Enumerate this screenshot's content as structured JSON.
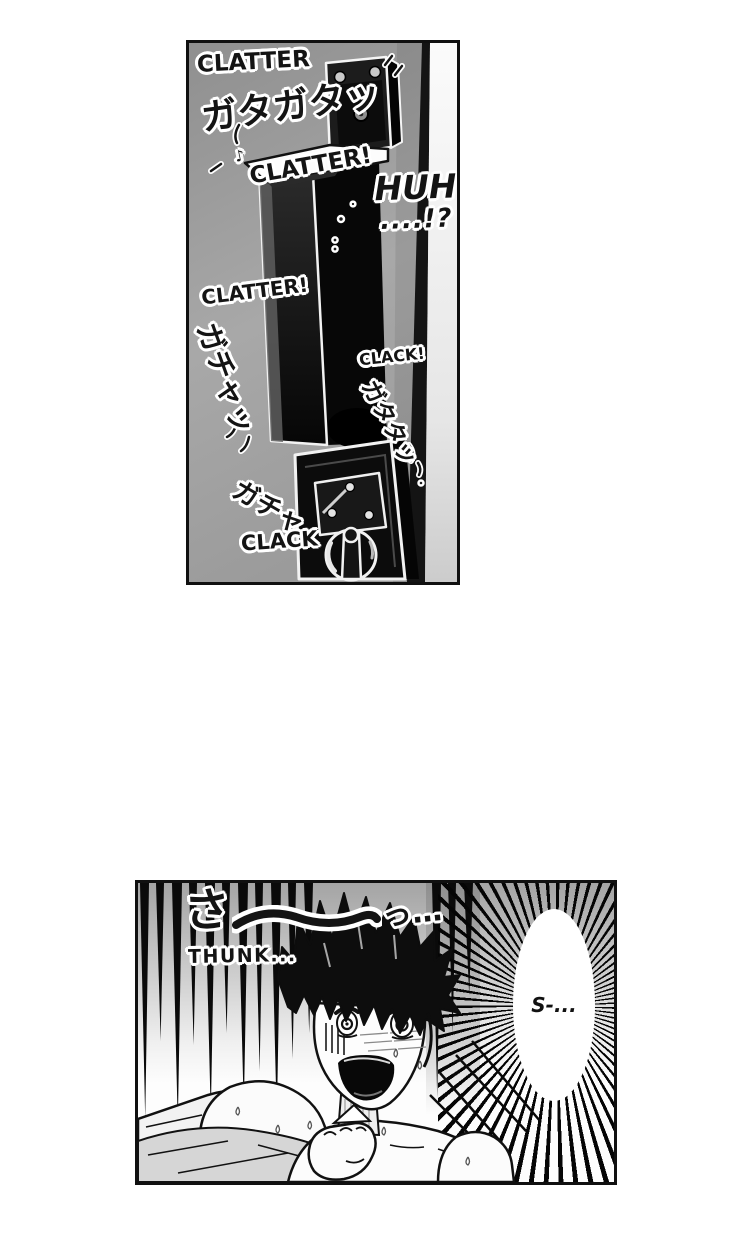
{
  "page": {
    "background": "#ffffff"
  },
  "door_panel": {
    "description": "door handle and lock rattling",
    "sfx": {
      "clatter_top": "CLATTER",
      "kana_rattle": "ガタガタッ",
      "clatter_mid": "CLATTER!",
      "huh_line1": "HUH",
      "huh_line2": "....!?",
      "clatter_low": "CLATTER!",
      "kana_jiggle_left": "ガチャッ",
      "clack_small": "CLACK!",
      "kana_rattle_right": "ガタタッ",
      "kana_jiggle_bottom": "ガチャ",
      "clack_bottom": "CLACK",
      "note_mark": "♪"
    }
  },
  "bedroom_panel": {
    "description": "startled boy sitting up in bed",
    "sfx": {
      "kana_sa": "さ",
      "kana_sa_tail": "っ…",
      "thunk": "THUNK..."
    },
    "speech_bubble": {
      "text": "S-..."
    }
  },
  "colors": {
    "panel_border": "#101010",
    "ink": "#141414",
    "door_gray": "#9c9c9c",
    "paper_white": "#ffffff"
  }
}
